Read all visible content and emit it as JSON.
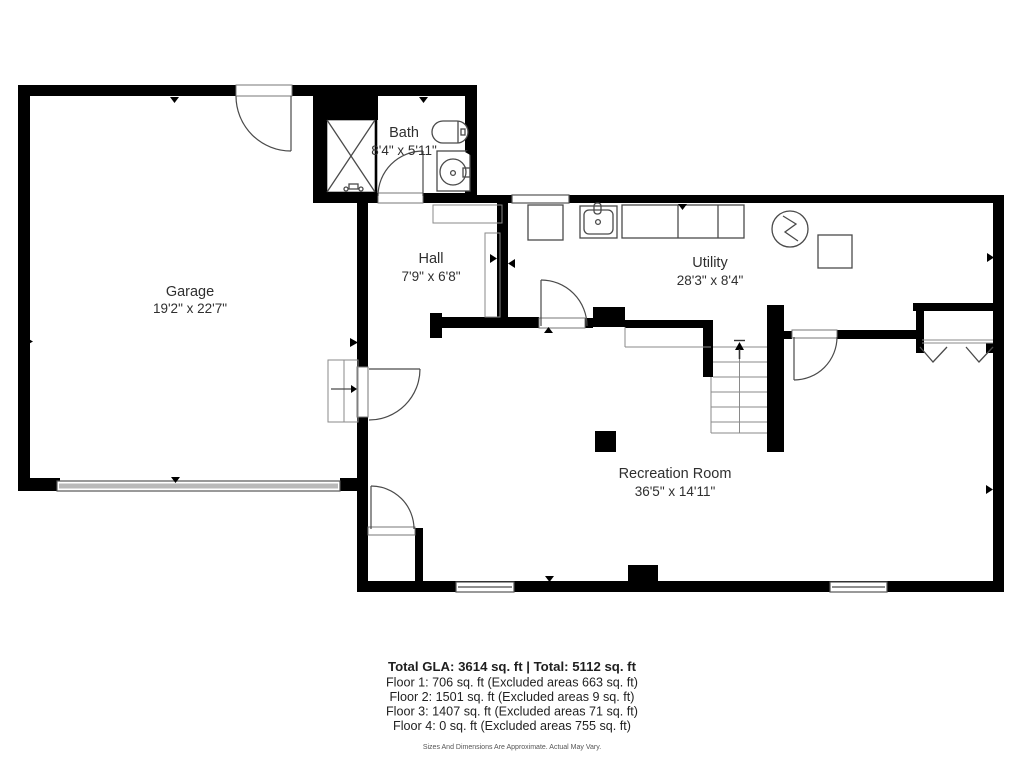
{
  "plan": {
    "rooms": {
      "garage": {
        "name": "Garage",
        "dims": "19'2\" x 22'7\""
      },
      "bath": {
        "name": "Bath",
        "dims": "8'4\" x 5'11\""
      },
      "hall": {
        "name": "Hall",
        "dims": "7'9\" x 6'8\""
      },
      "utility": {
        "name": "Utility",
        "dims": "28'3\" x 8'4\""
      },
      "recreation": {
        "name": "Recreation Room",
        "dims": "36'5\" x 14'11\""
      }
    },
    "fixtures": {
      "shower": "shower-stall",
      "toilet": "toilet",
      "bath_sink": "vanity-sink",
      "washer": "washer",
      "utility_sink": "laundry-sink",
      "counter": "counter",
      "water_heater": "water-heater",
      "box": "storage-box",
      "stairs": "staircase-up",
      "closet": "closet-rod-chevrons",
      "garage_door": "garage-door",
      "steps": "entry-steps"
    }
  },
  "summary": {
    "total_line": "Total GLA: 3614 sq. ft | Total: 5112 sq. ft",
    "floors": [
      "Floor 1: 706 sq. ft (Excluded areas 663 sq. ft)",
      "Floor 2: 1501 sq. ft (Excluded areas 9 sq. ft)",
      "Floor 3: 1407 sq. ft (Excluded areas 71 sq. ft)",
      "Floor 4: 0 sq. ft (Excluded areas 755 sq. ft)"
    ],
    "disclaimer": "Sizes And Dimensions Are Approximate. Actual May Vary."
  },
  "colors": {
    "wall": "#000000",
    "fixture": "#4a4a4a",
    "text": "#2f2f2f"
  }
}
